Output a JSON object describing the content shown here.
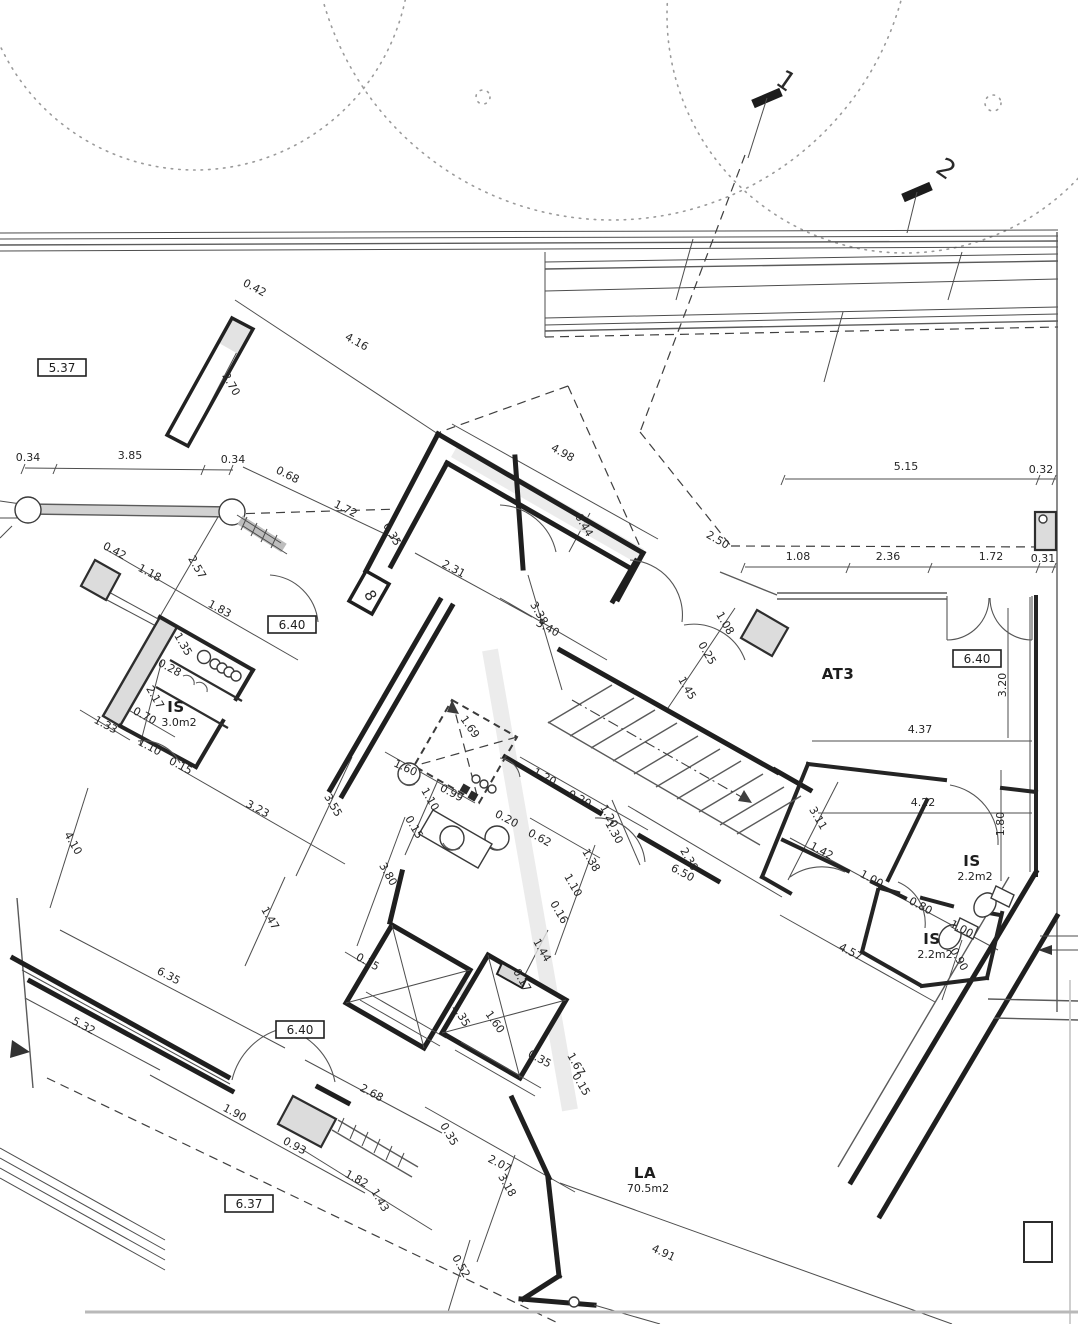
{
  "drawing": {
    "type": "architectural floor plan (scan)",
    "accent_color": "#1f1f1f",
    "paper_color": "#ffffff"
  },
  "rooms": [
    {
      "name": "IS",
      "area": "3.0m2",
      "x": 176,
      "y": 712
    },
    {
      "name": "AT3",
      "area": "",
      "x": 838,
      "y": 679
    },
    {
      "name": "IS",
      "area": "2.2m2",
      "x": 972,
      "y": 866
    },
    {
      "name": "IS",
      "area": "2.2m2",
      "x": 932,
      "y": 944
    },
    {
      "name": "LA",
      "area": "70.5m2",
      "x": 645,
      "y": 1178
    }
  ],
  "boxed_levels": [
    {
      "text": "5.37",
      "x": 62,
      "y": 372
    },
    {
      "text": "6.40",
      "x": 292,
      "y": 629
    },
    {
      "text": "6.40",
      "x": 977,
      "y": 663
    },
    {
      "text": "6.40",
      "x": 300,
      "y": 1034
    },
    {
      "text": "6.37",
      "x": 249,
      "y": 1208
    }
  ],
  "section_markers": [
    {
      "text": "1",
      "x": 781,
      "y": 88,
      "rot": 35
    },
    {
      "text": "2",
      "x": 941,
      "y": 176,
      "rot": 35
    }
  ],
  "annotations": [
    {
      "text": "8",
      "x": 366,
      "y": 598,
      "rot": 60
    }
  ],
  "dimensions": [
    {
      "text": "0.42",
      "x": 253,
      "y": 291,
      "rot": 28
    },
    {
      "text": "4.16",
      "x": 355,
      "y": 345,
      "rot": 29
    },
    {
      "text": "2.70",
      "x": 228,
      "y": 386,
      "rot": 60
    },
    {
      "text": "0.34",
      "x": 28,
      "y": 461,
      "rot": 0
    },
    {
      "text": "3.85",
      "x": 130,
      "y": 459,
      "rot": 0
    },
    {
      "text": "0.34",
      "x": 233,
      "y": 463,
      "rot": 0
    },
    {
      "text": "0.68",
      "x": 286,
      "y": 478,
      "rot": 27
    },
    {
      "text": "1.72",
      "x": 344,
      "y": 512,
      "rot": 27
    },
    {
      "text": "0.35",
      "x": 389,
      "y": 536,
      "rot": 60
    },
    {
      "text": "4.98",
      "x": 561,
      "y": 456,
      "rot": 29
    },
    {
      "text": "0.44",
      "x": 581,
      "y": 527,
      "rot": 60
    },
    {
      "text": "2.50",
      "x": 716,
      "y": 543,
      "rot": 30
    },
    {
      "text": "2.31",
      "x": 452,
      "y": 572,
      "rot": 28
    },
    {
      "text": "3.38",
      "x": 536,
      "y": 615,
      "rot": 60
    },
    {
      "text": "3.40",
      "x": 546,
      "y": 631,
      "rot": 29
    },
    {
      "text": "1.08",
      "x": 722,
      "y": 625,
      "rot": 60
    },
    {
      "text": "0.25",
      "x": 704,
      "y": 655,
      "rot": 60
    },
    {
      "text": "1.45",
      "x": 684,
      "y": 690,
      "rot": 60
    },
    {
      "text": "1.69",
      "x": 467,
      "y": 729,
      "rot": 55
    },
    {
      "text": "5.15",
      "x": 906,
      "y": 470,
      "rot": 0
    },
    {
      "text": "0.32",
      "x": 1041,
      "y": 473,
      "rot": 0
    },
    {
      "text": "1.08",
      "x": 798,
      "y": 560,
      "rot": 0
    },
    {
      "text": "2.36",
      "x": 888,
      "y": 560,
      "rot": 0
    },
    {
      "text": "1.72",
      "x": 991,
      "y": 560,
      "rot": 0
    },
    {
      "text": "0.31",
      "x": 1043,
      "y": 562,
      "rot": 0
    },
    {
      "text": "3.20",
      "x": 1006,
      "y": 685,
      "rot": -90
    },
    {
      "text": "4.37",
      "x": 920,
      "y": 733,
      "rot": 0
    },
    {
      "text": "0.42",
      "x": 113,
      "y": 554,
      "rot": 28
    },
    {
      "text": "1.18",
      "x": 148,
      "y": 576,
      "rot": 28
    },
    {
      "text": "2.57",
      "x": 194,
      "y": 569,
      "rot": 60
    },
    {
      "text": "1.83",
      "x": 218,
      "y": 612,
      "rot": 28
    },
    {
      "text": "1.35",
      "x": 180,
      "y": 646,
      "rot": 60
    },
    {
      "text": "0.28",
      "x": 168,
      "y": 671,
      "rot": 28
    },
    {
      "text": "2.17",
      "x": 152,
      "y": 699,
      "rot": 60
    },
    {
      "text": "0.70",
      "x": 143,
      "y": 719,
      "rot": 28
    },
    {
      "text": "1.33",
      "x": 104,
      "y": 728,
      "rot": 28
    },
    {
      "text": "1.10",
      "x": 148,
      "y": 750,
      "rot": 28
    },
    {
      "text": "0.15",
      "x": 179,
      "y": 769,
      "rot": 28
    },
    {
      "text": "1.60",
      "x": 404,
      "y": 771,
      "rot": 25
    },
    {
      "text": "1.10",
      "x": 427,
      "y": 801,
      "rot": 60
    },
    {
      "text": "0.99",
      "x": 450,
      "y": 796,
      "rot": 28
    },
    {
      "text": "0.15",
      "x": 411,
      "y": 829,
      "rot": 60
    },
    {
      "text": "3.80",
      "x": 385,
      "y": 876,
      "rot": 60
    },
    {
      "text": "0.20",
      "x": 505,
      "y": 822,
      "rot": 28
    },
    {
      "text": "0.62",
      "x": 538,
      "y": 841,
      "rot": 28
    },
    {
      "text": "1.38",
      "x": 588,
      "y": 862,
      "rot": 60
    },
    {
      "text": "1.20",
      "x": 543,
      "y": 780,
      "rot": 28
    },
    {
      "text": "0.20",
      "x": 578,
      "y": 802,
      "rot": 28
    },
    {
      "text": "1.20",
      "x": 606,
      "y": 818,
      "rot": 60
    },
    {
      "text": "1.30",
      "x": 611,
      "y": 834,
      "rot": 60
    },
    {
      "text": "2.30",
      "x": 686,
      "y": 861,
      "rot": 60
    },
    {
      "text": "6.50",
      "x": 681,
      "y": 876,
      "rot": 28
    },
    {
      "text": "1.10",
      "x": 570,
      "y": 887,
      "rot": 60
    },
    {
      "text": "0.16",
      "x": 556,
      "y": 914,
      "rot": 60
    },
    {
      "text": "1.44",
      "x": 539,
      "y": 952,
      "rot": 60
    },
    {
      "text": "0.17",
      "x": 519,
      "y": 982,
      "rot": 60
    },
    {
      "text": "0.15",
      "x": 366,
      "y": 965,
      "rot": 28
    },
    {
      "text": "1.35",
      "x": 458,
      "y": 1017,
      "rot": 60
    },
    {
      "text": "1.60",
      "x": 492,
      "y": 1024,
      "rot": 55
    },
    {
      "text": "0.35",
      "x": 538,
      "y": 1062,
      "rot": 28
    },
    {
      "text": "1.67",
      "x": 573,
      "y": 1066,
      "rot": 60
    },
    {
      "text": "0.15",
      "x": 578,
      "y": 1086,
      "rot": 60
    },
    {
      "text": "4.10",
      "x": 70,
      "y": 845,
      "rot": 60
    },
    {
      "text": "3.23",
      "x": 256,
      "y": 812,
      "rot": 28
    },
    {
      "text": "3.55",
      "x": 330,
      "y": 807,
      "rot": 60
    },
    {
      "text": "1.47",
      "x": 267,
      "y": 920,
      "rot": 60
    },
    {
      "text": "6.35",
      "x": 167,
      "y": 979,
      "rot": 28
    },
    {
      "text": "5.32",
      "x": 82,
      "y": 1029,
      "rot": 28
    },
    {
      "text": "1.90",
      "x": 233,
      "y": 1116,
      "rot": 28
    },
    {
      "text": "0.93",
      "x": 293,
      "y": 1149,
      "rot": 28
    },
    {
      "text": "1.82",
      "x": 355,
      "y": 1182,
      "rot": 28
    },
    {
      "text": "1.43",
      "x": 377,
      "y": 1202,
      "rot": 60
    },
    {
      "text": "2.68",
      "x": 370,
      "y": 1096,
      "rot": 28
    },
    {
      "text": "0.35",
      "x": 446,
      "y": 1136,
      "rot": 60
    },
    {
      "text": "2.07",
      "x": 498,
      "y": 1167,
      "rot": 28
    },
    {
      "text": "3.18",
      "x": 504,
      "y": 1187,
      "rot": 60
    },
    {
      "text": "0.52",
      "x": 458,
      "y": 1268,
      "rot": 60
    },
    {
      "text": "4.91",
      "x": 662,
      "y": 1256,
      "rot": 25
    },
    {
      "text": "3.11",
      "x": 815,
      "y": 820,
      "rot": 60
    },
    {
      "text": "1.42",
      "x": 820,
      "y": 854,
      "rot": 28
    },
    {
      "text": "1.00",
      "x": 870,
      "y": 882,
      "rot": 28
    },
    {
      "text": "0.80",
      "x": 919,
      "y": 909,
      "rot": 28
    },
    {
      "text": "1.00",
      "x": 960,
      "y": 932,
      "rot": 28
    },
    {
      "text": "0.90",
      "x": 956,
      "y": 961,
      "rot": 60
    },
    {
      "text": "4.57",
      "x": 849,
      "y": 955,
      "rot": 28
    },
    {
      "text": "4.22",
      "x": 923,
      "y": 806,
      "rot": 0
    },
    {
      "text": "1.80",
      "x": 1004,
      "y": 824,
      "rot": -90
    }
  ]
}
